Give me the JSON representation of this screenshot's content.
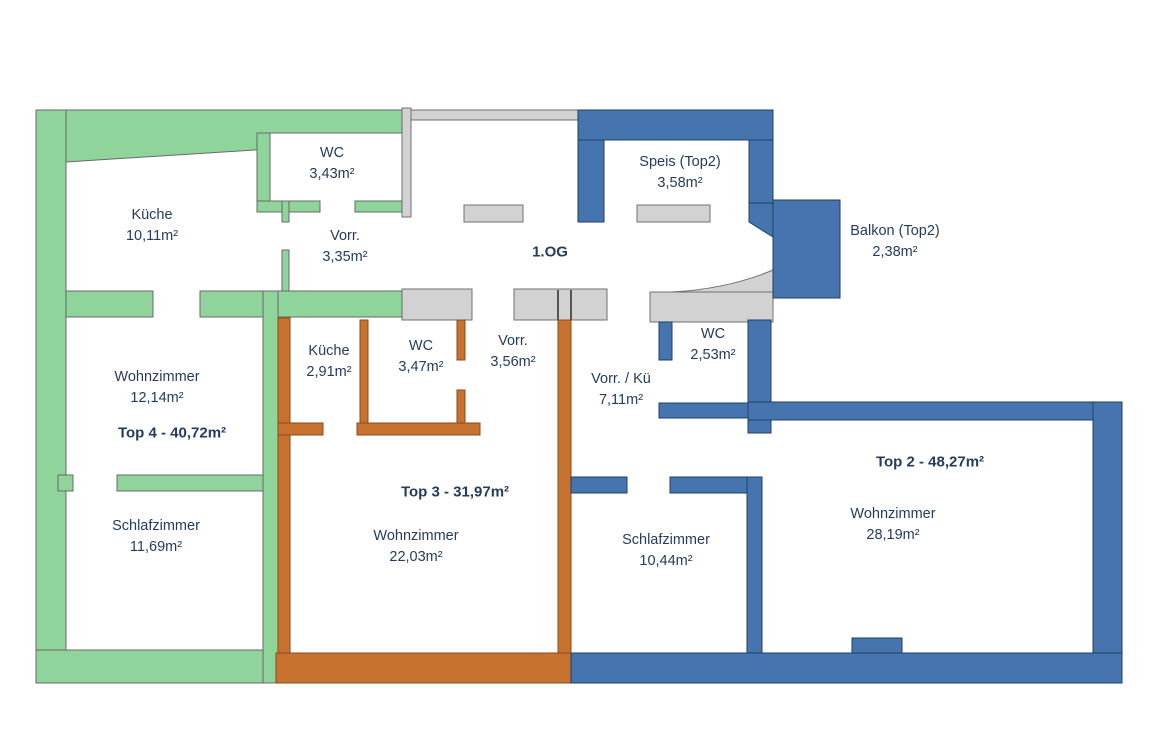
{
  "floor": {
    "label": "1.OG"
  },
  "units": {
    "top4": {
      "total_label": "Top 4 - 40,72m²",
      "color": "#8FD49B"
    },
    "top3": {
      "total_label": "Top 3 - 31,97m²",
      "color": "#C8722F"
    },
    "top2": {
      "total_label": "Top 2 - 48,27m²",
      "color": "#4674AE"
    }
  },
  "common": {
    "color": "#D2D2D2"
  },
  "text_color": "#263C5E",
  "rooms": {
    "wc_top4": {
      "name": "WC",
      "area": "3,43m²"
    },
    "kueche_top4": {
      "name": "Küche",
      "area": "10,11m²"
    },
    "vorr_top4": {
      "name": "Vorr.",
      "area": "3,35m²"
    },
    "wohnzimmer_top4": {
      "name": "Wohnzimmer",
      "area": "12,14m²"
    },
    "schlafzimmer_top4": {
      "name": "Schlafzimmer",
      "area": "11,69m²"
    },
    "kueche_top3": {
      "name": "Küche",
      "area": "2,91m²"
    },
    "wc_top3": {
      "name": "WC",
      "area": "3,47m²"
    },
    "vorr_top3": {
      "name": "Vorr.",
      "area": "3,56m²"
    },
    "wohnzimmer_top3": {
      "name": "Wohnzimmer",
      "area": "22,03m²"
    },
    "speis_top2": {
      "name": "Speis (Top2)",
      "area": "3,58m²"
    },
    "balkon_top2": {
      "name": "Balkon (Top2)",
      "area": "2,38m²"
    },
    "wc_top2": {
      "name": "WC",
      "area": "2,53m²"
    },
    "vorr_kue_top2": {
      "name": "Vorr. / Kü",
      "area": "7,11m²"
    },
    "schlafzimmer_top2": {
      "name": "Schlafzimmer",
      "area": "10,44m²"
    },
    "wohnzimmer_top2": {
      "name": "Wohnzimmer",
      "area": "28,19m²"
    }
  }
}
